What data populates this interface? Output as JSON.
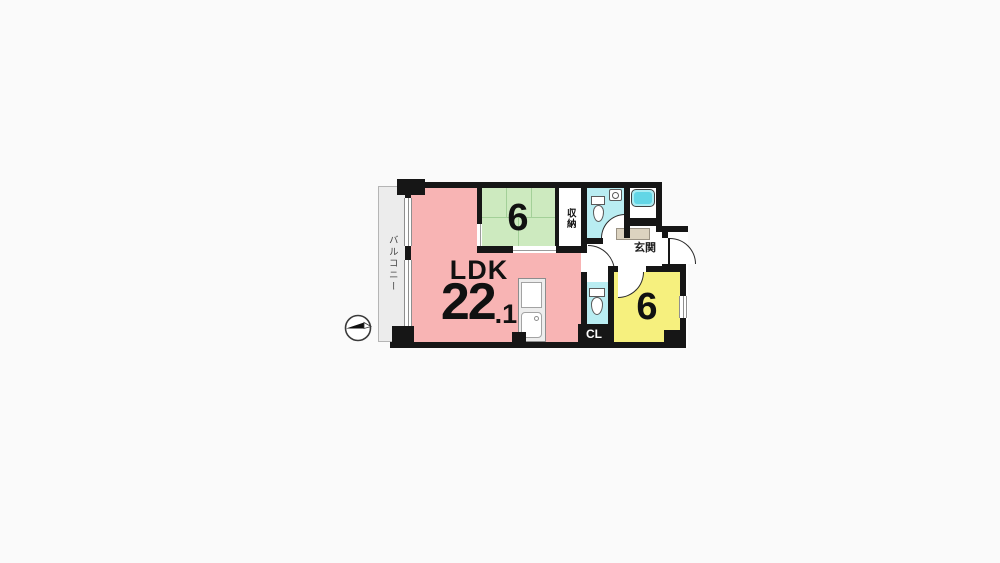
{
  "floor_plan": {
    "balcony": {
      "label": "バルコニー"
    },
    "ldk": {
      "label": "LDK",
      "area_main": "22",
      "area_decimal": ".1"
    },
    "tatami_room": {
      "size_label": "6"
    },
    "storage": {
      "label": "収納"
    },
    "entrance": {
      "label": "玄関"
    },
    "western_room": {
      "size_label": "6"
    },
    "closet": {
      "label": "CL"
    },
    "icons": {
      "compass": "north-arrow-compass",
      "toilet": "toilet-icon",
      "bathtub": "bathtub-icon",
      "sink": "sink-icon"
    },
    "colors": {
      "ldk": "#f8b4b4",
      "tatami": "#cdeabf",
      "western": "#f6f07e",
      "wet_area": "#b9edf2",
      "entrance_floor": "#dcd3c0",
      "balcony": "#ececec",
      "wall": "#161616",
      "background": "#fafafa"
    }
  }
}
